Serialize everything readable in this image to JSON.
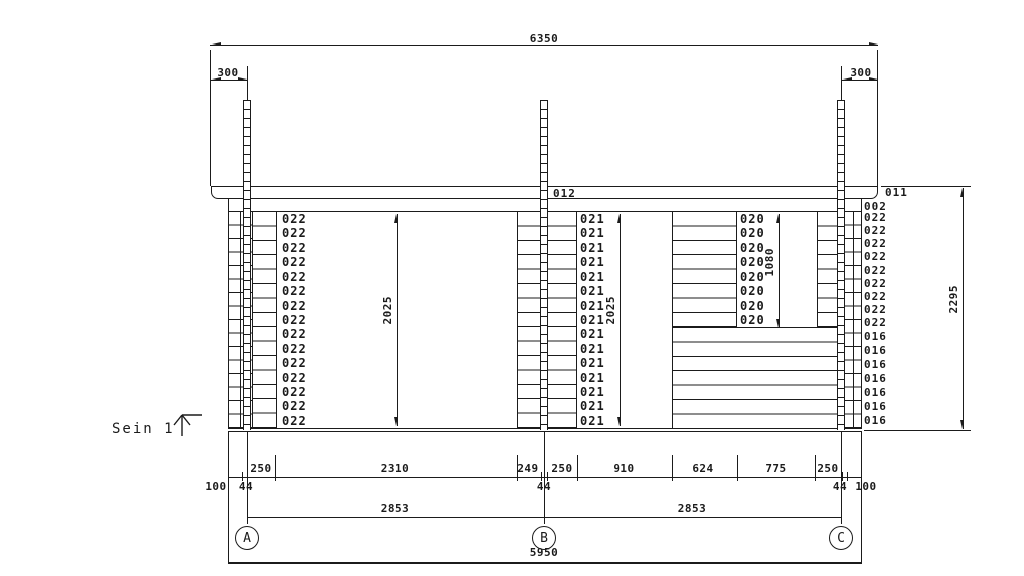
{
  "drawing": {
    "name": "Sein 1",
    "grid_bubbles": [
      "A",
      "B",
      "C"
    ],
    "part_labels": {
      "roof_beam": "012",
      "roof_beam_end": "011",
      "top_log": "002",
      "left_column": "022",
      "middle_column": "021",
      "window_column": "020",
      "right_column_upper": "022",
      "bottom_logs": "016",
      "left_column_count": 15,
      "middle_column_count": 15,
      "window_column_count": 8,
      "right_column_upper_count": 9,
      "bottom_logs_count": 7
    },
    "dimensions": {
      "top_total": "6350",
      "overhang_left": "300",
      "overhang_right": "300",
      "door_height": "2025",
      "opening_height": "2025",
      "window_height": "1080",
      "wall_height": "2295",
      "bottom_row1": [
        "250",
        "2310",
        "249",
        "250",
        "910",
        "624",
        "775",
        "250"
      ],
      "edge_left_100": "100",
      "post_a_44": "44",
      "post_b_44": "44",
      "post_c_44": "44",
      "edge_right_100": "100",
      "span_ab": "2853",
      "span_bc": "2853",
      "bottom_total": "5950"
    }
  }
}
